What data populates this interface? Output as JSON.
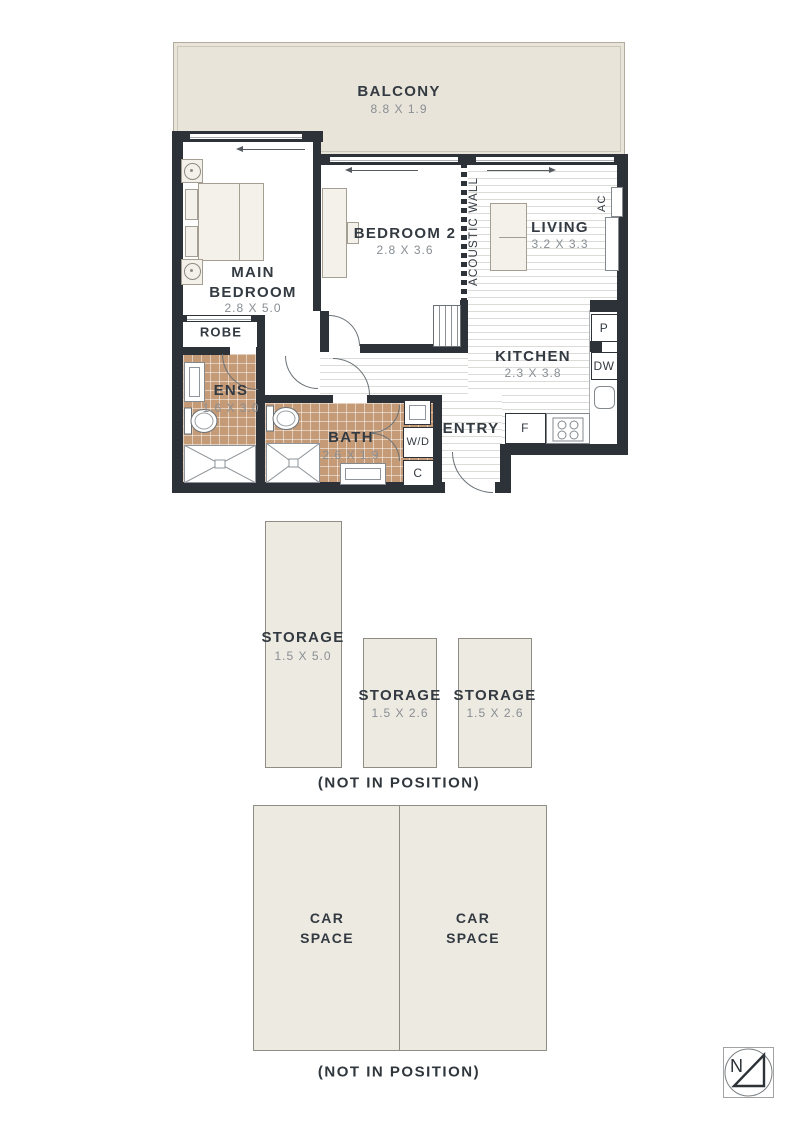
{
  "floorplan": {
    "balcony": {
      "name": "BALCONY",
      "dims": "8.8 X 1.9"
    },
    "main_bedroom": {
      "name": "MAIN BEDROOM",
      "dims": "2.8 X 5.0"
    },
    "bedroom2": {
      "name": "BEDROOM 2",
      "dims": "2.8 X 3.6"
    },
    "living": {
      "name": "LIVING",
      "dims": "3.2 X 3.3"
    },
    "kitchen": {
      "name": "KITCHEN",
      "dims": "2.3 X 3.8"
    },
    "ens": {
      "name": "ENS",
      "dims": "1.6 X 3.0"
    },
    "bath": {
      "name": "BATH",
      "dims": "2.6 X 1.9"
    },
    "labels": {
      "robe": "ROBE",
      "entry": "ENTRY",
      "acoustic_wall": "ACOUSTIC WALL",
      "ac": "AC",
      "pantry": "P",
      "dishwasher": "DW",
      "fridge": "F",
      "washer_dryer": "W/D",
      "cupboard": "C"
    }
  },
  "storage": {
    "units": [
      {
        "name": "STORAGE",
        "dims": "1.5 X 5.0"
      },
      {
        "name": "STORAGE",
        "dims": "1.5 X 2.6"
      },
      {
        "name": "STORAGE",
        "dims": "1.5 X 2.6"
      }
    ],
    "caption": "(NOT IN POSITION)"
  },
  "parking": {
    "spaces": [
      {
        "name": "CAR SPACE"
      },
      {
        "name": "CAR SPACE"
      }
    ],
    "caption": "(NOT IN POSITION)"
  },
  "compass": {
    "north": "N"
  },
  "colors": {
    "wall": "#2c3237",
    "balcony_fill": "#e9e4da",
    "zone_fill": "#edeae2",
    "tile_fill": "#c59a77",
    "text_dark": "#333a41",
    "text_dim": "#898e93"
  }
}
